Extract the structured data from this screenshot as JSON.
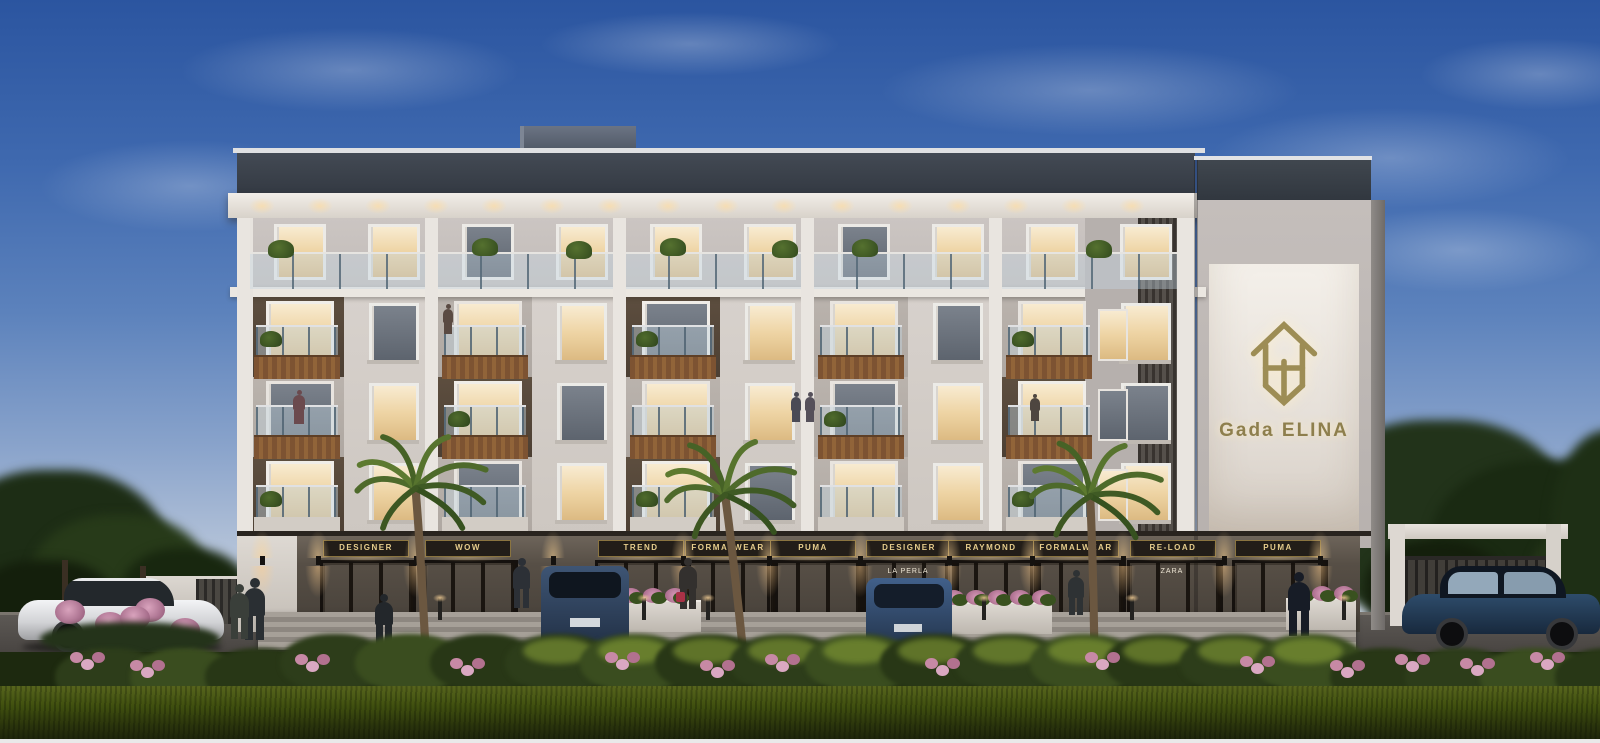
{
  "branding": {
    "project_name": "Gada ELINA",
    "logo_icon": "gada-house-monogram-icon",
    "gold_color": "#97874f"
  },
  "shops": {
    "signs": [
      {
        "label": "DESIGNER",
        "x": 365
      },
      {
        "label": "WOW",
        "x": 467
      },
      {
        "label": "TREND",
        "x": 640
      },
      {
        "label": "FORMALWEAR",
        "x": 727
      },
      {
        "label": "PUMA",
        "x": 812
      },
      {
        "label": "DESIGNER",
        "x": 908,
        "interior_brand": "LA PERLA"
      },
      {
        "label": "RAYMOND",
        "x": 990
      },
      {
        "label": "FORMALWEAR",
        "x": 1075
      },
      {
        "label": "RE-LOAD",
        "x": 1172,
        "interior_brand": "ZARA"
      },
      {
        "label": "PUMA",
        "x": 1277
      }
    ],
    "sign_text_color": "#e6cd8d",
    "sign_board_color": "#221d18"
  },
  "palette": {
    "sky_top": "#2b55a0",
    "sky_horizon": "#e4e6e6",
    "roof_band": "#3b4149",
    "facade_white": "#e7e3de",
    "facade_wall": "#d3cdc8",
    "wood_accent": "#8a5c36",
    "ground_floor": "#4a443d",
    "window_glow": "#f3dfb4",
    "glass_rail": "#c3d4e1",
    "grass": "#3c4a13",
    "hedge": "#2c3a1a",
    "flower_pink": "#cd90ac",
    "logo_gold": "#9d8d55"
  },
  "scene_objects": {
    "vehicles": [
      "white-coupe-car",
      "blue-suv-rear",
      "blue-sedan-rear",
      "dark-blue-sedan"
    ],
    "landscape": [
      "palm-tree",
      "palm-tree",
      "palm-tree",
      "street-hedge",
      "flower-planters",
      "lawn",
      "edge-trees"
    ]
  }
}
